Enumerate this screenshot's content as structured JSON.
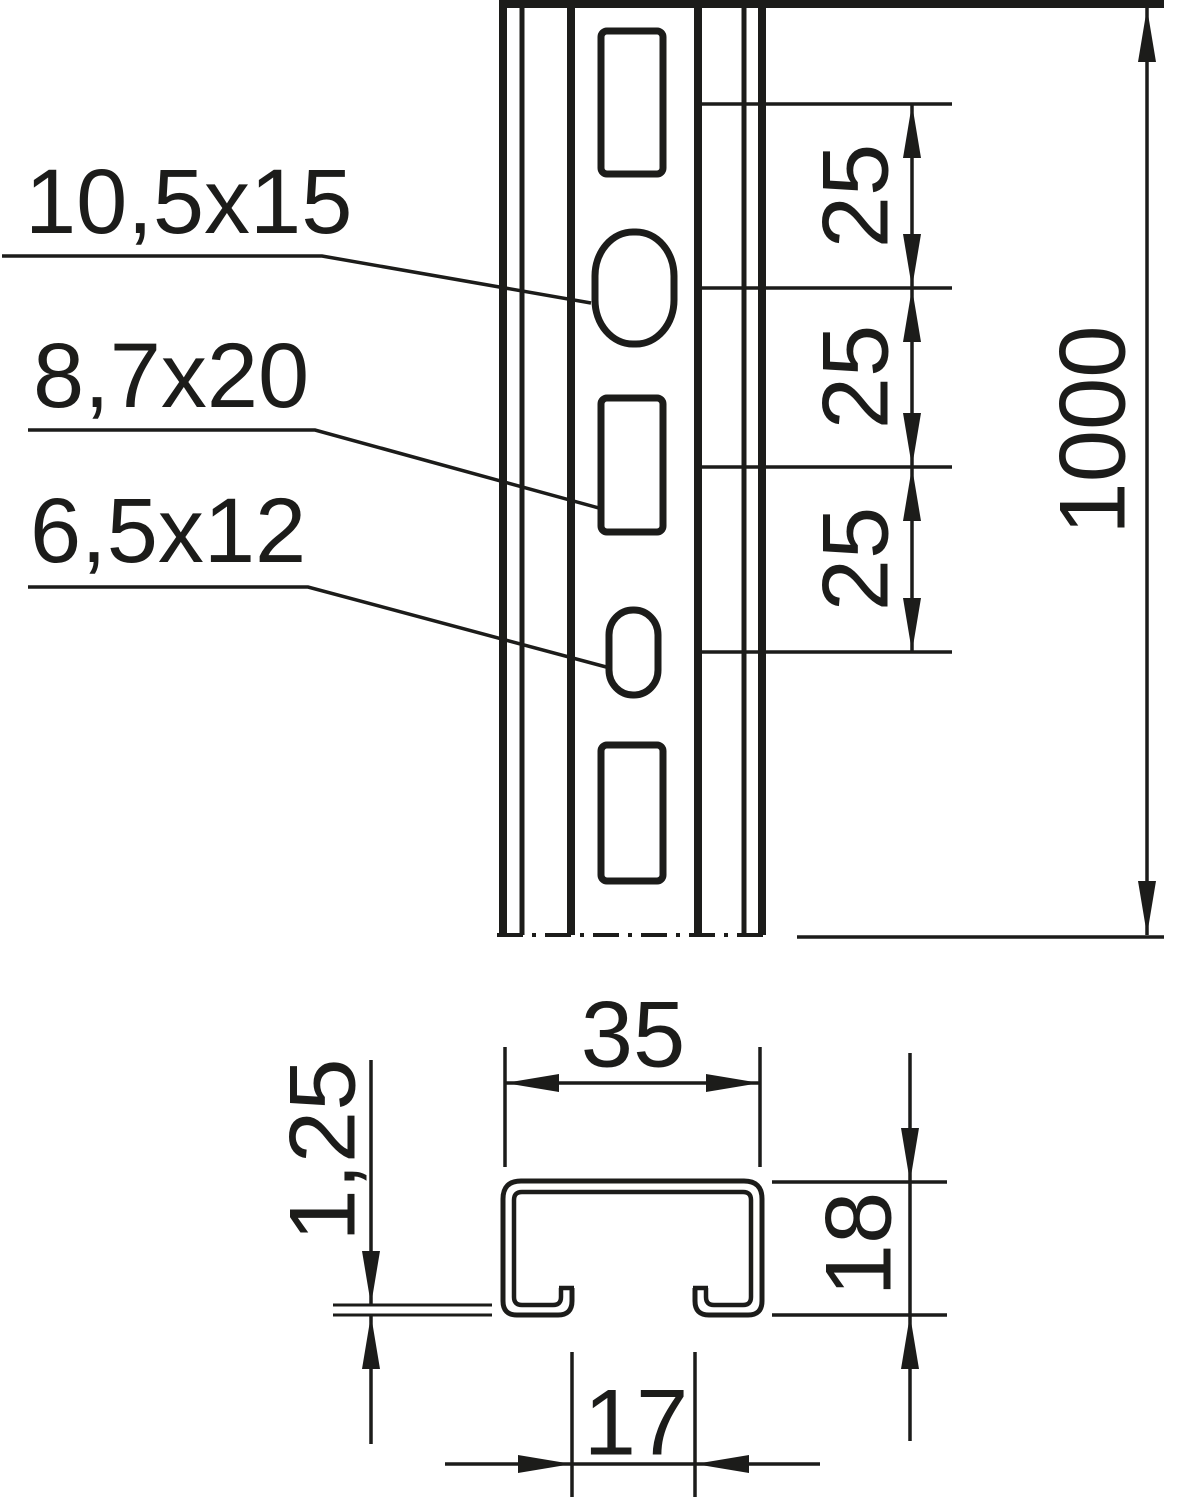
{
  "front_view": {
    "slot_labels": [
      "10,5x15",
      "8,7x20",
      "6,5x12"
    ],
    "pitch_dimensions": [
      "25",
      "25",
      "25"
    ],
    "length_dimension": "1000"
  },
  "cross_section": {
    "width_dimension": "35",
    "thickness_dimension": "1,25",
    "height_dimension": "18",
    "opening_dimension": "17"
  },
  "colors": {
    "line": "#1c1c1a",
    "background": "#ffffff"
  }
}
